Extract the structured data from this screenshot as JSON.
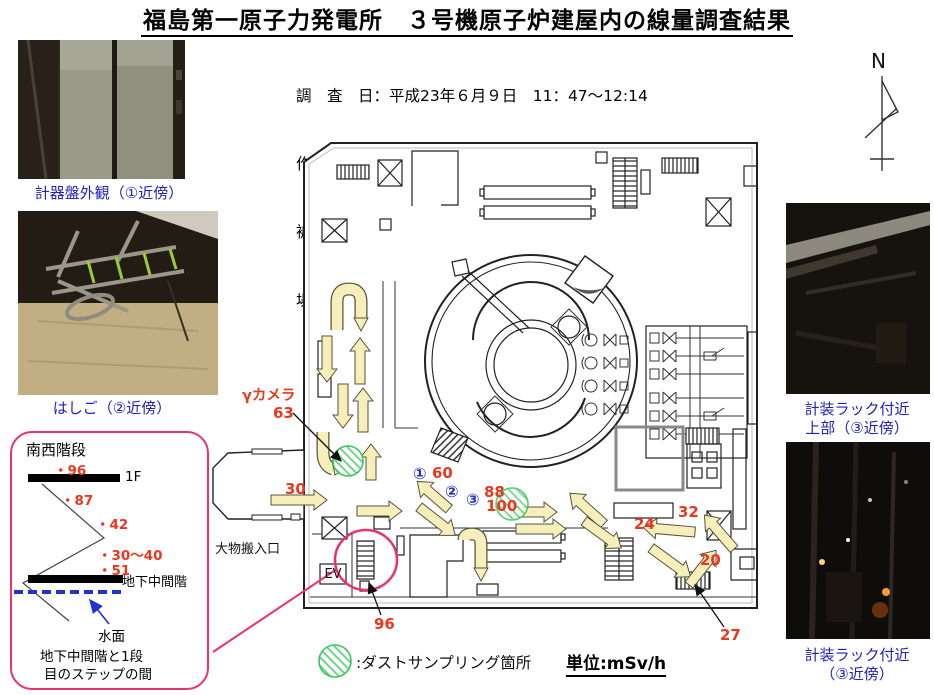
{
  "title": "福島第一原子力発電所　３号機原子炉建屋内の線量調査結果",
  "survey_info": {
    "lines": [
      "調　査　日：平成23年６月９日　11：47～12:14",
      "作　業　員：９名（当社５名、協力企業４名）",
      "被ばく線量：5.88～7.98mSv",
      "場　　　所：３号機原子炉建屋 1階南側・西側"
    ]
  },
  "compass": {
    "label": "N"
  },
  "photos": {
    "left_top": {
      "caption": "計器盤外観（①近傍）"
    },
    "left_bottom": {
      "caption": "はしご（②近傍）"
    },
    "right_top": {
      "caption_line1": "計装ラック付近",
      "caption_line2": "上部（③近傍）"
    },
    "right_bottom": {
      "caption_line1": "計装ラック付近",
      "caption_line2": "（③近傍）"
    }
  },
  "stairs_inset": {
    "title": "南西階段",
    "floor_label": "1F",
    "basement_label": "地下中間階",
    "water_label": "水面",
    "note_line1": "地下中間階と1段",
    "note_line2": "目のステップの間",
    "readings": [
      {
        "text": "・96"
      },
      {
        "text": "・87"
      },
      {
        "text": "・42"
      },
      {
        "text": "・30～40"
      },
      {
        "text": "・51"
      }
    ]
  },
  "floor_plan": {
    "gamma_camera_label": "γカメラ",
    "gamma_camera_value": "63",
    "hatch_label": "大物搬入口",
    "elevator_label": "EV",
    "dose_values": [
      {
        "value": "30",
        "x": 285,
        "y": 494
      },
      {
        "value": "60",
        "x": 432,
        "y": 478
      },
      {
        "value": "88",
        "x": 484,
        "y": 497
      },
      {
        "value": "100",
        "x": 486,
        "y": 511
      },
      {
        "value": "96",
        "x": 374,
        "y": 629
      },
      {
        "value": "24",
        "x": 634,
        "y": 529
      },
      {
        "value": "32",
        "x": 678,
        "y": 517
      },
      {
        "value": "20",
        "x": 700,
        "y": 565
      },
      {
        "value": "27",
        "x": 720,
        "y": 640
      }
    ],
    "point_markers": [
      {
        "label": "①",
        "x": 413,
        "y": 479
      },
      {
        "label": "②",
        "x": 445,
        "y": 497
      },
      {
        "label": "③",
        "x": 466,
        "y": 505
      }
    ]
  },
  "legend": {
    "dust_sampling": ":ダストサンプリング箇所",
    "unit": "単位:mSv/h"
  }
}
